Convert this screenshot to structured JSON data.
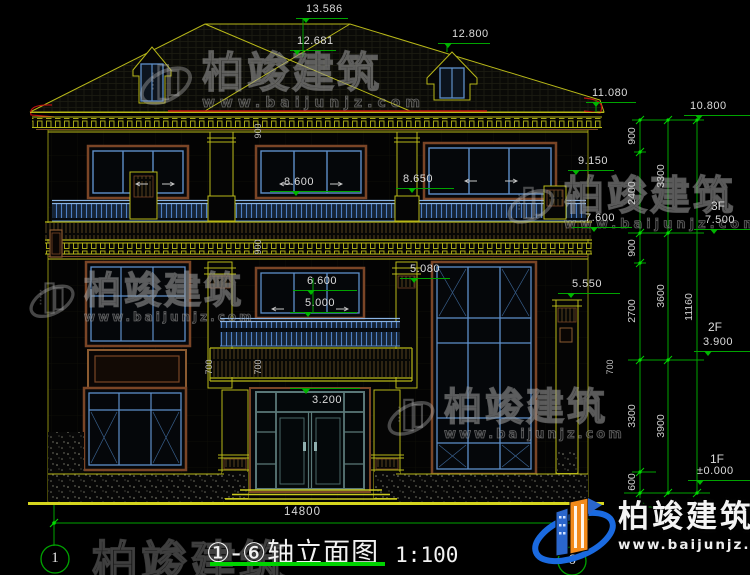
{
  "title": {
    "name": "①-⑥轴立面图",
    "scale": "1:100"
  },
  "axes": {
    "left": "1",
    "right": "6"
  },
  "bottom_dim": "14800",
  "levels": [
    {
      "v": "13.586"
    },
    {
      "v": "12.681"
    },
    {
      "v": "12.800"
    },
    {
      "v": "11.080"
    },
    {
      "v": "10.800"
    },
    {
      "v": "9.150"
    },
    {
      "v": "8.600"
    },
    {
      "v": "8.650"
    },
    {
      "v": "7.600"
    },
    {
      "v": "7.500",
      "floor": "3F"
    },
    {
      "v": "6.600"
    },
    {
      "v": "5.080"
    },
    {
      "v": "5.550"
    },
    {
      "v": "5.000"
    },
    {
      "v": "3.900",
      "floor": "2F"
    },
    {
      "v": "3.200"
    },
    {
      "v": "±0.000",
      "floor": "1F"
    }
  ],
  "dims": {
    "chain_inner": [
      "900",
      "2400",
      "900",
      "2700",
      "3300",
      "600"
    ],
    "chain_mid": [
      "3300",
      "3600",
      "3900"
    ],
    "chain_outer": [
      "11160"
    ],
    "small": [
      "900",
      "900",
      "700",
      "700",
      "700"
    ]
  },
  "watermark": {
    "brand": "柏竣建筑",
    "site": "www.baijunjz.com"
  },
  "colors": {
    "line_yellow": "#b8b818",
    "dim_green": "#00a400",
    "window_blue": "#4e7fc4",
    "trim_brown": "#7a4526",
    "accent_red": "#bb1111",
    "logo_blue": "#1a6ae0",
    "logo_orange": "#f28a1a"
  }
}
